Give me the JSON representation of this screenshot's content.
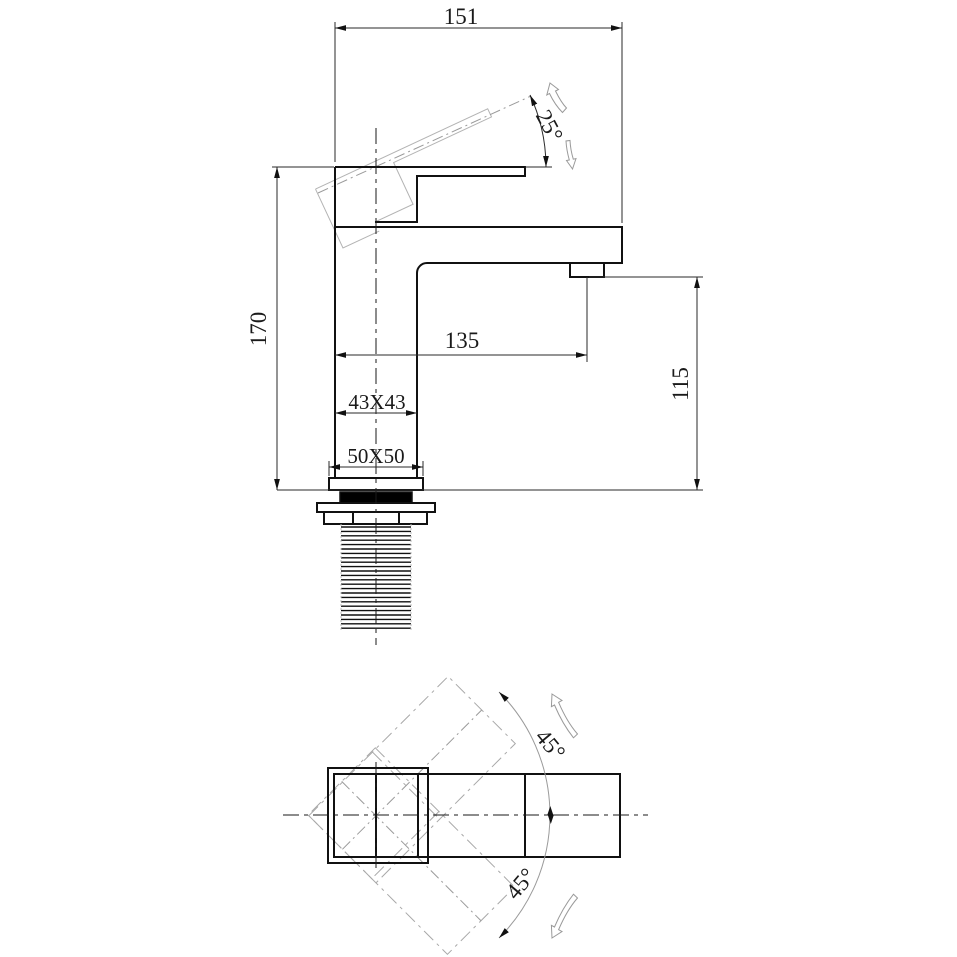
{
  "drawing": {
    "type": "technical-drawing",
    "colors": {
      "line": "#111111",
      "dimension": "#2a2a2a",
      "phantom": "#b3b3b3",
      "background": "#ffffff"
    },
    "front_view": {
      "dims": {
        "overall_width": "151",
        "overall_height": "170",
        "spout_reach": "135",
        "outlet_height": "115",
        "body_section": "43X43",
        "base_section": "50X50",
        "handle_lift_angle": "25°"
      }
    },
    "plan_view": {
      "dims": {
        "swing_upper": "45°",
        "swing_lower": "45°"
      }
    }
  }
}
